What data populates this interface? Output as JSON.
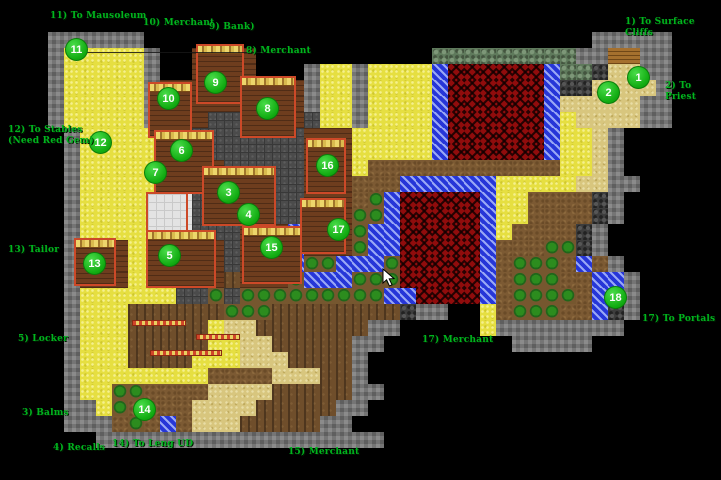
{
  "map": {
    "colors": {
      "background": "#000000",
      "marker_fill": "#14b014",
      "marker_text": "#ffffff",
      "label_text": "#00b41e"
    },
    "markers": [
      {
        "number": "1",
        "x": 638,
        "y": 77
      },
      {
        "number": "2",
        "x": 608,
        "y": 92
      },
      {
        "number": "3",
        "x": 228,
        "y": 192
      },
      {
        "number": "4",
        "x": 248,
        "y": 214
      },
      {
        "number": "5",
        "x": 169,
        "y": 255
      },
      {
        "number": "6",
        "x": 181,
        "y": 150
      },
      {
        "number": "7",
        "x": 155,
        "y": 172
      },
      {
        "number": "8",
        "x": 267,
        "y": 108
      },
      {
        "number": "9",
        "x": 215,
        "y": 82
      },
      {
        "number": "10",
        "x": 168,
        "y": 98
      },
      {
        "number": "11",
        "x": 76,
        "y": 49
      },
      {
        "number": "12",
        "x": 100,
        "y": 142
      },
      {
        "number": "13",
        "x": 94,
        "y": 263
      },
      {
        "number": "14",
        "x": 144,
        "y": 409
      },
      {
        "number": "15",
        "x": 271,
        "y": 247
      },
      {
        "number": "16",
        "x": 327,
        "y": 165
      },
      {
        "number": "17",
        "x": 338,
        "y": 229
      },
      {
        "number": "18",
        "x": 615,
        "y": 297
      }
    ],
    "labels": [
      {
        "id": "to-mausoleum",
        "text": "11) To Mausoleum",
        "x": 50,
        "y": 11
      },
      {
        "id": "merchant-10",
        "text": "10) Merchant",
        "x": 143,
        "y": 18
      },
      {
        "id": "bank",
        "text": "9) Bank)",
        "x": 209,
        "y": 22
      },
      {
        "id": "merchant-8",
        "text": "8) Merchant",
        "x": 246,
        "y": 46
      },
      {
        "id": "to-surface-cliffs",
        "text": "1) To Surface Cliffs",
        "x": 625,
        "y": 17
      },
      {
        "id": "to-priest",
        "text": "2) To Priest",
        "x": 665,
        "y": 81
      },
      {
        "id": "to-stables",
        "text": "12) To Stables\n(Need Red Gem)",
        "x": 8,
        "y": 125
      },
      {
        "id": "tailor",
        "text": "13) Tailor",
        "x": 8,
        "y": 245
      },
      {
        "id": "locker",
        "text": "5) Locker",
        "x": 18,
        "y": 334
      },
      {
        "id": "balms",
        "text": "3) Balms",
        "x": 22,
        "y": 408
      },
      {
        "id": "recalls",
        "text": "4) Recalls",
        "x": 53,
        "y": 443
      },
      {
        "id": "to-leng-ud",
        "text": "14) To Leng UD",
        "x": 112,
        "y": 439
      },
      {
        "id": "merchant-15",
        "text": "15) Merchant",
        "x": 288,
        "y": 447
      },
      {
        "id": "merchant-17",
        "text": "17) Merchant",
        "x": 422,
        "y": 335
      },
      {
        "id": "to-portals",
        "text": "17) To Portals",
        "x": 642,
        "y": 314
      }
    ]
  },
  "cursor": {
    "x": 382,
    "y": 268
  }
}
